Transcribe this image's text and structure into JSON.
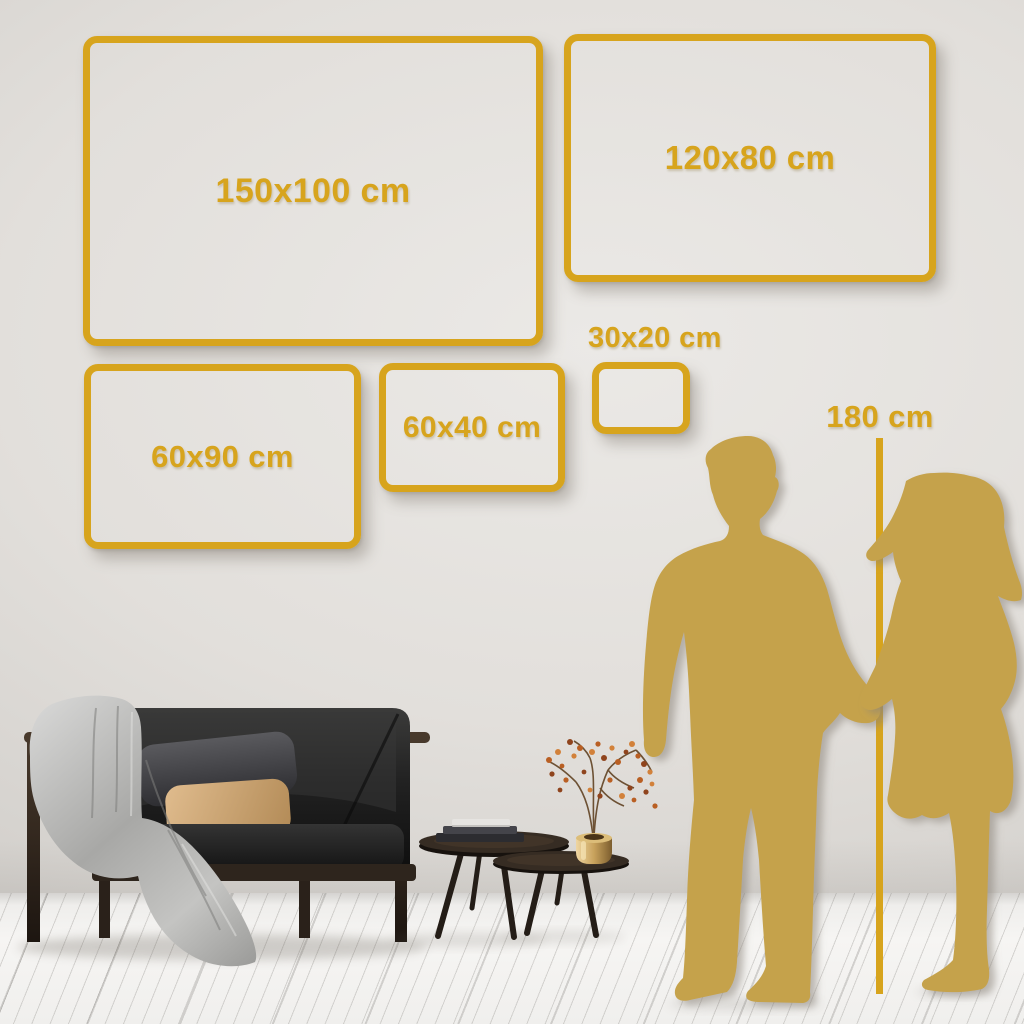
{
  "frames": [
    {
      "label": "150x100 cm",
      "width_cm": 150,
      "height_cm": 100
    },
    {
      "label": "120x80 cm",
      "width_cm": 120,
      "height_cm": 80
    },
    {
      "label": "60x90 cm",
      "width_cm": 60,
      "height_cm": 90
    },
    {
      "label": "60x40 cm",
      "width_cm": 60,
      "height_cm": 40
    },
    {
      "label": "30x20 cm",
      "width_cm": 30,
      "height_cm": 20
    }
  ],
  "reference": {
    "label": "180 cm"
  },
  "colors": {
    "accent_gold": "#D7A41D",
    "silhouette_gold": "#C5A24B",
    "wall_base": "#DEDBD7",
    "floor_base": "#F3F2F0"
  },
  "scene": {
    "elements": [
      "sofa",
      "throw-blanket",
      "pillows",
      "coffee-tables",
      "books",
      "brass-vase",
      "dried-branch",
      "man-silhouette",
      "woman-silhouette",
      "height-reference-line"
    ]
  }
}
